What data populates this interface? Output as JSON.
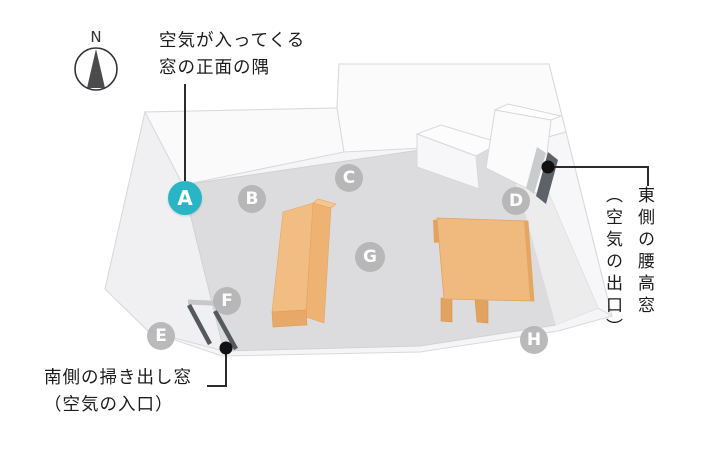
{
  "compass": {
    "label": "N"
  },
  "callouts": {
    "inlet_corner": {
      "line1": "空気が入ってくる",
      "line2": "窓の正面の隅"
    },
    "east_window": {
      "line1": "東側の腰高窓",
      "line2": "（空気の出口）"
    },
    "south_window": {
      "line1": "南側の掃き出し窓",
      "line2": "（空気の入口）"
    }
  },
  "markers": [
    {
      "label": "A",
      "x": 185,
      "y": 198,
      "r": 17,
      "highlight": true
    },
    {
      "label": "B",
      "x": 252,
      "y": 199,
      "r": 14,
      "highlight": false
    },
    {
      "label": "C",
      "x": 349,
      "y": 178,
      "r": 14,
      "highlight": false
    },
    {
      "label": "D",
      "x": 516,
      "y": 201,
      "r": 14,
      "highlight": false
    },
    {
      "label": "E",
      "x": 161,
      "y": 336,
      "r": 14,
      "highlight": false
    },
    {
      "label": "F",
      "x": 227,
      "y": 301,
      "r": 14,
      "highlight": false
    },
    {
      "label": "G",
      "x": 370,
      "y": 257,
      "r": 15,
      "highlight": false
    },
    {
      "label": "H",
      "x": 534,
      "y": 340,
      "r": 14,
      "highlight": false
    }
  ],
  "colors": {
    "highlight": "#2ab5c6",
    "marker_gray": "#b5b5b6",
    "floor": "#dcdcde",
    "wall": "#fafafb",
    "furniture_orange": "#f0b97c",
    "window_dark": "#5d6268",
    "leader_line": "#2b2b2b"
  }
}
